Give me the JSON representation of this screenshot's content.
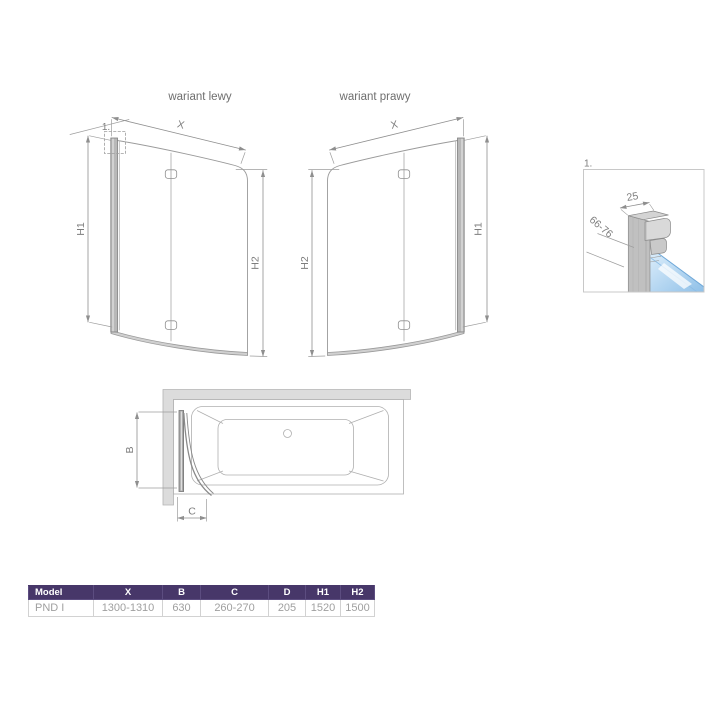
{
  "titles": {
    "left_variant": "wariant lewy",
    "right_variant": "wariant prawy"
  },
  "labels": {
    "x": "X",
    "h1": "H1",
    "h2": "H2",
    "b": "B",
    "c": "C",
    "detail_ref": "1.",
    "profile_width": "25",
    "profile_adjust_range": "66-76"
  },
  "table": {
    "headers": [
      "Model",
      "X",
      "B",
      "C",
      "D",
      "H1",
      "H2"
    ],
    "row": [
      "PND I",
      "1300-1310",
      "630",
      "260-270",
      "205",
      "1520",
      "1500"
    ]
  },
  "colors": {
    "table_header": "#473769",
    "glass_blue": "#aed4f2",
    "line_gray": "#9b9b9b",
    "profile_gray": "#b8b8b8"
  }
}
